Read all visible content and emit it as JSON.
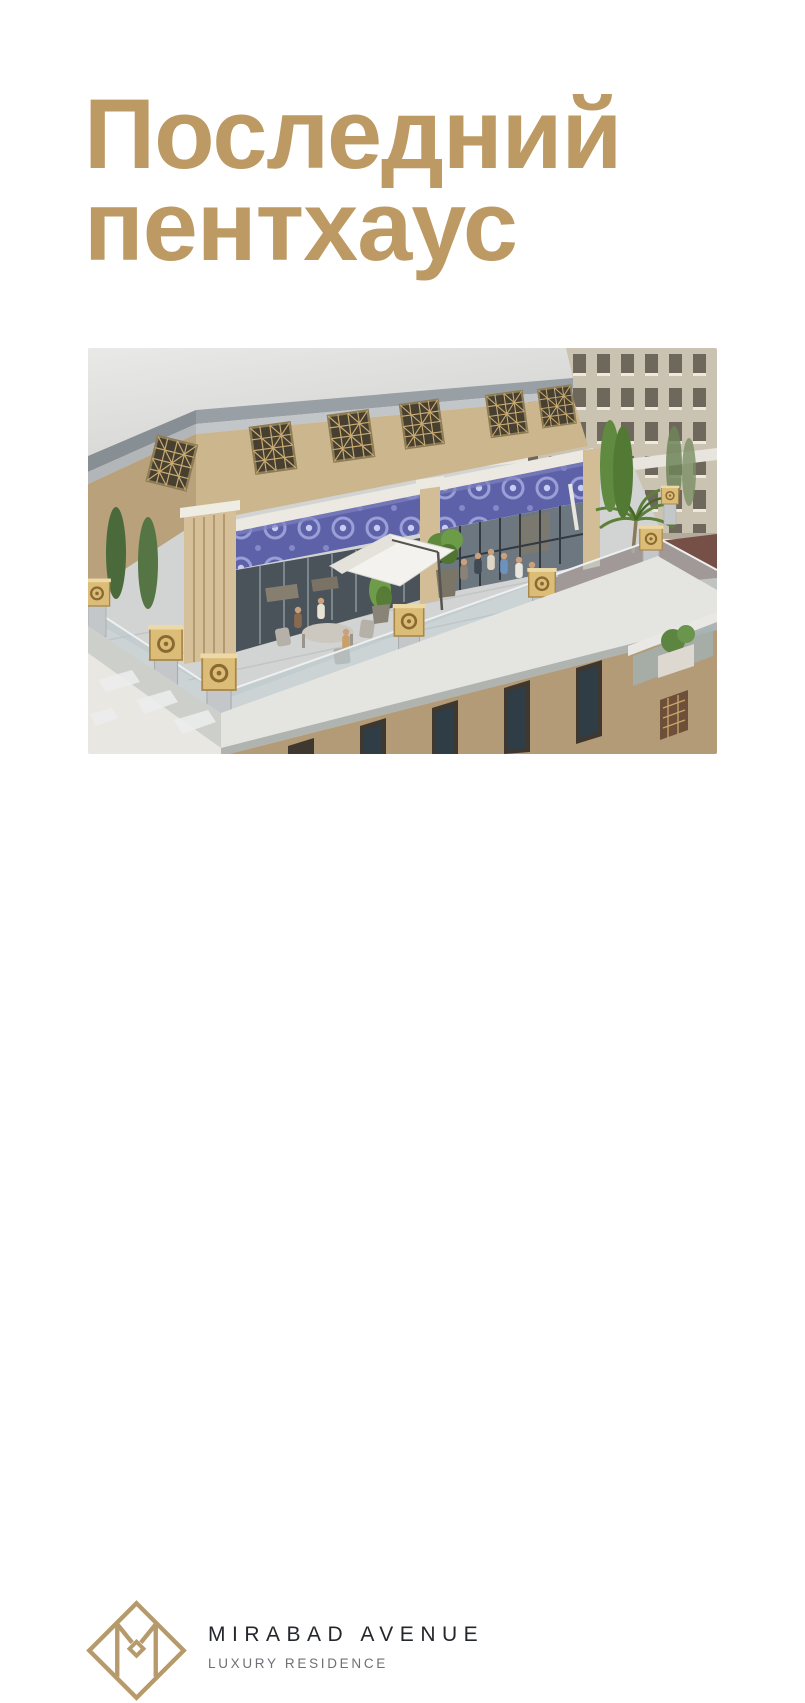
{
  "page": {
    "background_color": "#ffffff",
    "accent_gold": "#BD9A64"
  },
  "headline": {
    "line1": "Последний",
    "line2": "пентхаус",
    "color": "#BD9A64"
  },
  "brand": {
    "name": "MIRABAD AVENUE",
    "tagline": "LUXURY RESIDENCE",
    "logo_color": "#B69A6B",
    "name_color": "#24272C",
    "tagline_color": "#6D7075"
  }
}
